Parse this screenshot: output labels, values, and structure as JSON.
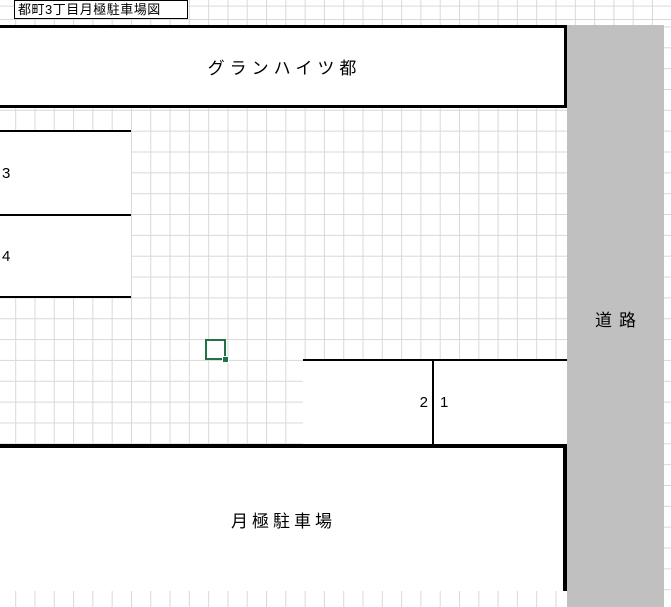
{
  "sheet": {
    "title_cell": "都町3丁目月極駐車場図"
  },
  "map": {
    "building_label": "グランハイツ都",
    "road_label": "道路",
    "parking_lot_label": "月極駐車場",
    "spaces": [
      {
        "id": "space-3",
        "label": "3"
      },
      {
        "id": "space-4",
        "label": "4"
      },
      {
        "id": "space-2",
        "label": "2"
      },
      {
        "id": "space-1",
        "label": "1"
      }
    ]
  },
  "selection": {
    "cursor_cell": ""
  },
  "colors": {
    "road_fill": "#c0c0c0",
    "gridline": "#d9d9d9",
    "border": "#000000",
    "selection_green": "#217346"
  }
}
